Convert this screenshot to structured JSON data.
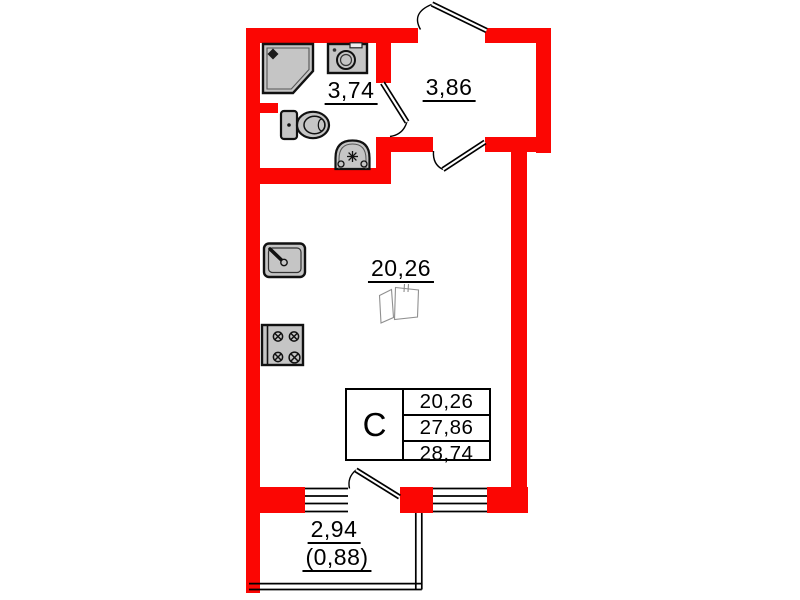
{
  "plan_labels": {
    "bathroom_area": "3,74",
    "hallway_area": "3,86",
    "room_area": "20,26",
    "balcony_area": "2,94",
    "balcony_area_reduced": "(0,88)"
  },
  "summary_table": {
    "type": "С",
    "rows": [
      "20,26",
      "27,86",
      "28,74"
    ]
  },
  "colors": {
    "wall": "#fb0603",
    "fixture": "#c5c5c5",
    "line": "#000000"
  },
  "icons": {
    "shower": "shower-icon",
    "washing_machine": "washing-machine-icon",
    "toilet": "toilet-icon",
    "bathroom_sink": "sink-icon",
    "kitchen_sink": "kitchen-sink-icon",
    "stove": "stove-icon",
    "wardrobe": "wardrobe-dashed-icon",
    "window": "window-icon",
    "door": "door-swing-icon"
  }
}
